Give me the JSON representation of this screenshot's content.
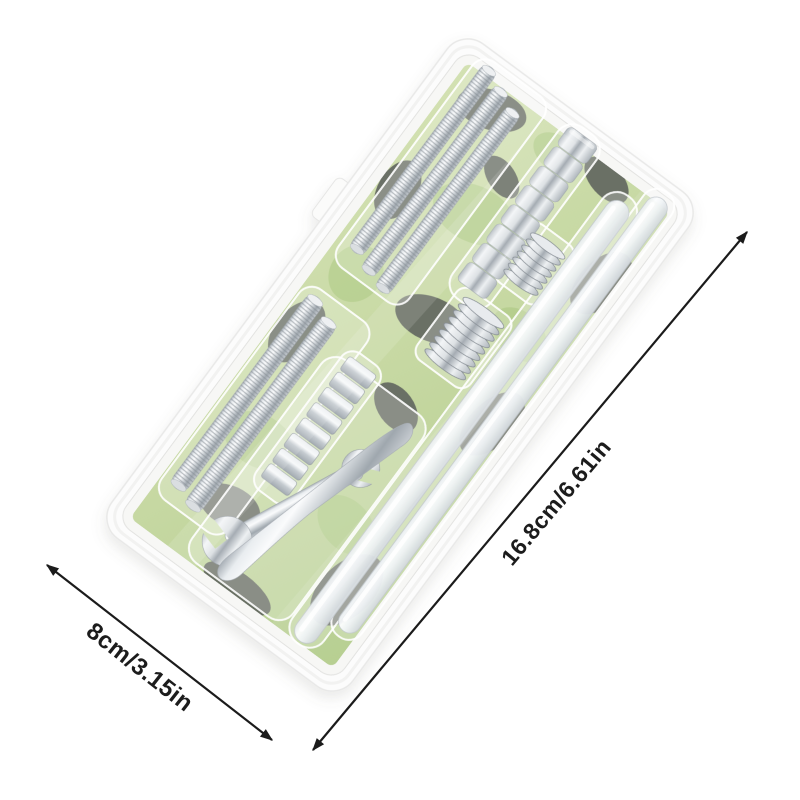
{
  "scene": {
    "background_color": "#ffffff",
    "description": "product photo of a clear blister pack hardware kit on white background with dimension arrows"
  },
  "annotations": {
    "length_label": "16.8cm/6.61in",
    "width_label": "8cm/3.15in",
    "arrow_color": "#1b1b1b"
  },
  "package": {
    "type": "clear-blister-pack",
    "backing_card": {
      "base_color": "#c6d8a2",
      "camo_dark_color": "#5f645e",
      "camo_light_color": "#a9c77f"
    },
    "contents": [
      {
        "name": "long-threaded-rods",
        "count": 3
      },
      {
        "name": "hex-nut-stack",
        "count": 8
      },
      {
        "name": "thin-disc-stack-small",
        "count": 7
      },
      {
        "name": "thin-disc-stack-large",
        "count": 9
      },
      {
        "name": "medium-threaded-rods",
        "count": 2
      },
      {
        "name": "cylinder-magnet-stack",
        "count": 8
      },
      {
        "name": "open-end-wrench",
        "count": 1
      },
      {
        "name": "flat-pry-tool",
        "count": 1
      },
      {
        "name": "glue-sticks",
        "count": 2
      }
    ]
  }
}
